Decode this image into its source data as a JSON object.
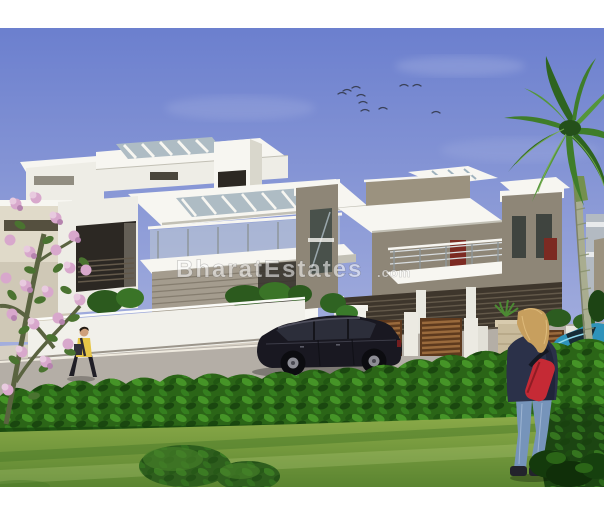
{
  "watermark": {
    "text_main": "BharatEstates",
    "text_suffix": ".com"
  },
  "palette": {
    "sky_top": "#6b7fce",
    "sky_bottom": "#aeb7e0",
    "roof_white": "#f7f6f1",
    "wall_white": "#eeede6",
    "wall_shade": "#d9d7cc",
    "fascia_shadow": "#c2c0b5",
    "glass_strip": "#aebcc4",
    "glass_rail": "#c3ced2",
    "window_dark": "#2c2823",
    "frame_dark": "#4a463c",
    "taupe": "#8e8677",
    "taupe_light": "#9b927f",
    "louver_dark": "#3e362c",
    "louver_line": "#63594a",
    "cream_bld": "#e0dac9",
    "grey_bld": "#b3bac2",
    "road": "#b4aea6",
    "sidewalk": "#d6cfc3",
    "compound_wall": "#f1f0ea",
    "wood_dark": "#5e3a1e",
    "wood_slat": "#9a6a3c",
    "stone_pillar": "#c9bb9c",
    "hedge_base": "#2b6517",
    "hedge_dark": "#16400d",
    "hedge_light": "#4ea22c",
    "lawn_light": "#8cab49",
    "lawn_dark": "#5a8430",
    "bush_dark": "#1c4512",
    "palm_leaf_a": "#2e6420",
    "palm_leaf_b": "#3f7d2a",
    "palm_leaf_c": "#54963a",
    "palm_trunk": "#a9ad90",
    "trunk_ring": "#868f6a",
    "flower_a": "#d8a8cc",
    "flower_b": "#e8cadf",
    "flower_c": "#b583ae",
    "tree_leaf": "#4a7330",
    "tree_stem": "#5a6340",
    "car_dark_body": "#191821",
    "car_window": "#2c2e3a",
    "alloy_grey": "#8e8e96",
    "car_blue_body": "#2e93ba",
    "windshield_dark": "#16262e",
    "skin": "#cfa07c",
    "hair_dark": "#241c14",
    "shirt_yellow": "#e7c647",
    "pants_dark": "#201e26",
    "hair_blonde": "#c79f5e",
    "jacket_navy": "#2b3149",
    "bag_red": "#c52a35",
    "jeans_blue": "#7694ba",
    "shoe_dark": "#23232c",
    "door_red": "#7c2a22",
    "bird_dark": "#3a4158",
    "border_white": "#ffffff"
  },
  "scene": {
    "description": "3D architectural rendering of modern duplex villas with landscaped garden and driveway",
    "objects": [
      "sky",
      "flying-birds",
      "palm-tree",
      "flowering-tree",
      "white-villa",
      "taupe-villa",
      "background-houses",
      "compound-wall",
      "wooden-gate-fence",
      "driveway-road",
      "garden-hedge",
      "lawn",
      "trimmed-bushes",
      "parked-dark-car",
      "parked-blue-car",
      "pedestrian-walking",
      "woman-standing"
    ]
  }
}
